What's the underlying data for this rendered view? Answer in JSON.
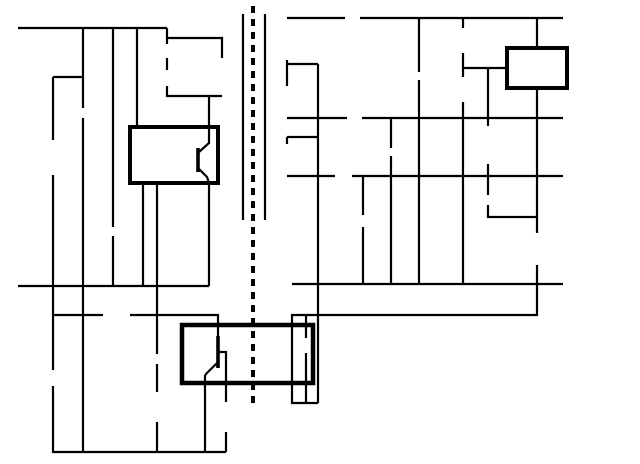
{
  "title": "LM2577 isolated flyback power supply schematic with red annotation",
  "colors": {
    "ink": "#000000",
    "annotation": "#dd1515",
    "bg": "#ffffff"
  },
  "annotations": {
    "circle": {
      "cx": 357,
      "cy": 119,
      "r": 26,
      "stroke_w": 5.5
    },
    "block_arrow": {
      "points": "358,40 378,40 378,61 389,61 368,88 347,61 358,61",
      "stroke_w": 5
    }
  },
  "texts": [
    {
      "t": "V",
      "x": 8,
      "y": 45,
      "s": 16
    },
    {
      "t": "IN",
      "x": 20,
      "y": 50,
      "s": 10
    },
    {
      "t": "16 - 36V",
      "x": 5,
      "y": 63,
      "s": 13
    },
    {
      "t": "+",
      "x": 66,
      "y": 104,
      "s": 15
    },
    {
      "t": "680",
      "x": 86,
      "y": 131,
      "s": 13
    },
    {
      "t": "µF",
      "x": 86,
      "y": 145,
      "s": 13
    },
    {
      "t": "10K",
      "x": 18,
      "y": 163,
      "s": 13
    },
    {
      "t": "0.1",
      "x": 87,
      "y": 200,
      "s": 13
    },
    {
      "t": "µF",
      "x": 87,
      "y": 214,
      "s": 13
    },
    {
      "t": "V",
      "x": 133,
      "y": 117,
      "s": 13
    },
    {
      "t": "IN",
      "x": 142,
      "y": 121,
      "s": 9
    },
    {
      "t": "SW",
      "x": 190,
      "y": 117,
      "s": 13
    },
    {
      "t": "LM2577",
      "x": 162,
      "y": 154,
      "s": 14,
      "a": "middle"
    },
    {
      "t": "ADJ",
      "x": 162,
      "y": 172,
      "s": 14,
      "a": "middle"
    },
    {
      "t": "FB",
      "x": 120,
      "y": 201,
      "s": 13
    },
    {
      "t": "COMP",
      "x": 164,
      "y": 201,
      "s": 13
    },
    {
      "t": "GND",
      "x": 216,
      "y": 201,
      "s": 13
    },
    {
      "t": "18T",
      "x": 186,
      "y": 69,
      "s": 13
    },
    {
      "t": "51V",
      "x": 175,
      "y": 83,
      "s": 13
    },
    {
      "t": "INPUT",
      "x": 3,
      "y": 263,
      "s": 13
    },
    {
      "t": "GND",
      "x": 3,
      "y": 279,
      "s": 13
    },
    {
      "t": "100k",
      "x": 97,
      "y": 335,
      "s": 13
    },
    {
      "t": "0.47µF",
      "x": 95,
      "y": 380,
      "s": 13
    },
    {
      "t": "2K",
      "x": 168,
      "y": 413,
      "s": 13
    },
    {
      "t": "4.7V",
      "x": 13,
      "y": 392,
      "s": 13
    },
    {
      "t": "4N27",
      "x": 201,
      "y": 315,
      "s": 14
    },
    {
      "t": "47K",
      "x": 232,
      "y": 418,
      "s": 13
    },
    {
      "t": "ISOLATION",
      "x": 264,
      "y": 234,
      "s": 12.5,
      "a": "middle",
      "r": -90
    },
    {
      "t": "16T",
      "x": 293,
      "y": 45,
      "s": 13
    },
    {
      "t": "24T",
      "x": 294,
      "y": 98,
      "s": 13
    },
    {
      "t": "24T",
      "x": 293,
      "y": 157,
      "s": 13
    },
    {
      "t": "470µF",
      "x": 401,
      "y": 78,
      "s": 13,
      "a": "end"
    },
    {
      "t": "+",
      "x": 404,
      "y": 67,
      "s": 14
    },
    {
      "t": "220µF",
      "x": 371,
      "y": 154,
      "s": 13,
      "a": "end"
    },
    {
      "t": "+",
      "x": 376,
      "y": 145,
      "s": 14
    },
    {
      "t": "100µF",
      "x": 318,
      "y": 212,
      "s": 13
    },
    {
      "t": "+",
      "x": 348,
      "y": 243,
      "s": 14
    },
    {
      "t": "R1",
      "x": 452,
      "y": 38,
      "s": 13,
      "a": "end"
    },
    {
      "t": "15K",
      "x": 452,
      "y": 52,
      "s": 13,
      "a": "end"
    },
    {
      "t": "R2",
      "x": 452,
      "y": 92,
      "s": 13,
      "a": "end"
    },
    {
      "t": "45.3K",
      "x": 456,
      "y": 106,
      "s": 13,
      "a": "end"
    },
    {
      "t": "FB",
      "x": 485,
      "y": 63,
      "s": 13,
      "a": "end"
    },
    {
      "t": "LM385",
      "x": 537,
      "y": 74,
      "s": 14,
      "a": "middle"
    },
    {
      "t": "+",
      "x": 521,
      "y": 44,
      "s": 15
    },
    {
      "t": "-",
      "x": 525,
      "y": 101,
      "s": 17
    },
    {
      "t": "220",
      "x": 496,
      "y": 149,
      "s": 13
    },
    {
      "t": "0.1",
      "x": 511,
      "y": 194,
      "s": 13
    },
    {
      "t": "µF",
      "x": 511,
      "y": 208,
      "s": 13
    },
    {
      "t": "470",
      "x": 529,
      "y": 256,
      "s": 13,
      "a": "end"
    },
    {
      "t": "5V@",
      "x": 582,
      "y": 19,
      "s": 14
    },
    {
      "t": "150mA",
      "x": 582,
      "y": 35,
      "s": 14
    },
    {
      "t": "7.5V@",
      "x": 582,
      "y": 118,
      "s": 14
    },
    {
      "t": "100mA",
      "x": 582,
      "y": 134,
      "s": 14
    },
    {
      "t": "-7.5V@",
      "x": 579,
      "y": 176,
      "s": 14
    },
    {
      "t": "70mA",
      "x": 582,
      "y": 192,
      "s": 14
    },
    {
      "t": "OUTPUT",
      "x": 575,
      "y": 284,
      "s": 14
    },
    {
      "t": "GND",
      "x": 588,
      "y": 300,
      "s": 14
    }
  ],
  "geometry": {
    "wires": [
      [
        [
          18,
          28
        ],
        [
          167,
          28
        ]
      ],
      [
        [
          83,
          28
        ],
        [
          83,
          108
        ]
      ],
      [
        [
          83,
          118
        ],
        [
          83,
          452
        ]
      ],
      [
        [
          113,
          28
        ],
        [
          113,
          227
        ]
      ],
      [
        [
          113,
          236
        ],
        [
          113,
          286
        ]
      ],
      [
        [
          137,
          28
        ],
        [
          137,
          127
        ]
      ],
      [
        [
          167,
          28
        ],
        [
          167,
          44
        ]
      ],
      [
        [
          167,
          58
        ],
        [
          167,
          70
        ]
      ],
      [
        [
          167,
          86
        ],
        [
          167,
          96
        ],
        [
          222,
          96
        ]
      ],
      [
        [
          209,
          96
        ],
        [
          209,
          127
        ]
      ],
      [
        [
          167,
          38
        ],
        [
          222,
          38
        ],
        [
          222,
          58
        ]
      ],
      [
        [
          53,
          77
        ],
        [
          83,
          77
        ]
      ],
      [
        [
          53,
          77
        ],
        [
          53,
          140
        ]
      ],
      [
        [
          53,
          175
        ],
        [
          53,
          370
        ]
      ],
      [
        [
          53,
          386
        ],
        [
          53,
          452
        ],
        [
          226,
          452
        ]
      ],
      [
        [
          18,
          286
        ],
        [
          209,
          286
        ]
      ],
      [
        [
          209,
          183
        ],
        [
          209,
          286
        ]
      ],
      [
        [
          143,
          183
        ],
        [
          143,
          286
        ]
      ],
      [
        [
          157,
          183
        ],
        [
          157,
          315
        ]
      ],
      [
        [
          53,
          315
        ],
        [
          103,
          315
        ]
      ],
      [
        [
          130,
          315
        ],
        [
          157,
          315
        ]
      ],
      [
        [
          157,
          315
        ],
        [
          218,
          315
        ],
        [
          218,
          336
        ]
      ],
      [
        [
          218,
          352
        ],
        [
          226,
          352
        ],
        [
          226,
          402
        ]
      ],
      [
        [
          226,
          432
        ],
        [
          226,
          452
        ]
      ],
      [
        [
          157,
          315
        ],
        [
          157,
          354
        ]
      ],
      [
        [
          157,
          364
        ],
        [
          157,
          392
        ]
      ],
      [
        [
          157,
          422
        ],
        [
          157,
          452
        ]
      ],
      [
        [
          209,
          127
        ],
        [
          209,
          143
        ],
        [
          199,
          152
        ]
      ],
      [
        [
          198,
          168
        ],
        [
          207,
          177
        ],
        [
          209,
          183
        ]
      ],
      [
        [
          218,
          362
        ],
        [
          205,
          375
        ]
      ],
      [
        [
          205,
          375
        ],
        [
          205,
          452
        ]
      ],
      [
        [
          243,
          14
        ],
        [
          243,
          220
        ]
      ],
      [
        [
          265,
          14
        ],
        [
          265,
          220
        ]
      ],
      [
        [
          287,
          18
        ],
        [
          345,
          18
        ]
      ],
      [
        [
          360,
          18
        ],
        [
          563,
          18
        ]
      ],
      [
        [
          419,
          18
        ],
        [
          419,
          72
        ]
      ],
      [
        [
          419,
          80
        ],
        [
          419,
          284
        ]
      ],
      [
        [
          463,
          18
        ],
        [
          463,
          28
        ]
      ],
      [
        [
          463,
          53
        ],
        [
          463,
          77
        ]
      ],
      [
        [
          463,
          102
        ],
        [
          463,
          284
        ]
      ],
      [
        [
          463,
          68
        ],
        [
          507,
          68
        ]
      ],
      [
        [
          488,
          68
        ],
        [
          488,
          126
        ]
      ],
      [
        [
          488,
          164
        ],
        [
          488,
          195
        ]
      ],
      [
        [
          488,
          205
        ],
        [
          488,
          217
        ],
        [
          537,
          217
        ]
      ],
      [
        [
          537,
          18
        ],
        [
          537,
          48
        ]
      ],
      [
        [
          537,
          88
        ],
        [
          537,
          233
        ]
      ],
      [
        [
          537,
          265
        ],
        [
          537,
          315
        ],
        [
          292,
          315
        ],
        [
          292,
          403
        ],
        [
          318,
          403
        ]
      ],
      [
        [
          306,
          315
        ],
        [
          306,
          338
        ]
      ],
      [
        [
          306,
          353
        ],
        [
          306,
          403
        ]
      ],
      [
        [
          287,
          60
        ],
        [
          287,
          86
        ]
      ],
      [
        [
          287,
          118
        ],
        [
          347,
          118
        ]
      ],
      [
        [
          362,
          118
        ],
        [
          563,
          118
        ]
      ],
      [
        [
          287,
          64
        ],
        [
          318,
          64
        ]
      ],
      [
        [
          318,
          64
        ],
        [
          318,
          403
        ]
      ],
      [
        [
          287,
          137
        ],
        [
          318,
          137
        ]
      ],
      [
        [
          287,
          137
        ],
        [
          287,
          144
        ]
      ],
      [
        [
          287,
          176
        ],
        [
          335,
          176
        ]
      ],
      [
        [
          352,
          176
        ],
        [
          563,
          176
        ]
      ],
      [
        [
          391,
          118
        ],
        [
          391,
          148
        ]
      ],
      [
        [
          391,
          156
        ],
        [
          391,
          284
        ]
      ],
      [
        [
          363,
          176
        ],
        [
          363,
          215
        ]
      ],
      [
        [
          363,
          227
        ],
        [
          363,
          284
        ]
      ],
      [
        [
          292,
          284
        ],
        [
          563,
          284
        ]
      ]
    ],
    "thick_wires": [
      [
        [
          198,
          148
        ],
        [
          198,
          172
        ]
      ],
      [
        [
          218,
          336
        ],
        [
          218,
          368
        ]
      ]
    ],
    "dashed": {
      "x": 253,
      "y1": 6,
      "y2": 405,
      "w": 4,
      "dash": "7 6"
    },
    "boxes": [
      {
        "x": 130,
        "y": 127,
        "w": 88,
        "h": 56,
        "sw": 4,
        "name": "lm2577-box"
      },
      {
        "x": 507,
        "y": 48,
        "w": 60,
        "h": 40,
        "sw": 4,
        "name": "lm385-box"
      },
      {
        "x": 182,
        "y": 325,
        "w": 131,
        "h": 58,
        "sw": 4.5,
        "name": "4n27-box"
      }
    ],
    "resistors": [
      {
        "x": 53,
        "y": 140,
        "len": 35,
        "o": "v",
        "name": "resistor-10k"
      },
      {
        "x": 103,
        "y": 315,
        "len": 27,
        "o": "h",
        "name": "resistor-100k"
      },
      {
        "x": 157,
        "y": 392,
        "len": 30,
        "o": "v",
        "name": "resistor-2k"
      },
      {
        "x": 226,
        "y": 402,
        "len": 30,
        "o": "v",
        "name": "resistor-47k"
      },
      {
        "x": 463,
        "y": 28,
        "len": 25,
        "o": "v",
        "name": "resistor-r1-15k"
      },
      {
        "x": 463,
        "y": 77,
        "len": 25,
        "o": "v",
        "name": "resistor-r2-45k"
      },
      {
        "x": 488,
        "y": 126,
        "len": 38,
        "o": "v",
        "name": "resistor-220"
      },
      {
        "x": 537,
        "y": 233,
        "len": 32,
        "o": "v",
        "name": "resistor-470"
      }
    ],
    "capacitors": [
      {
        "cx": 83,
        "y1": 108,
        "y2": 118,
        "hw": 18,
        "name": "cap-680uF"
      },
      {
        "cx": 113,
        "y1": 227,
        "y2": 236,
        "hw": 18,
        "name": "cap-0.1uF-input"
      },
      {
        "cx": 157,
        "y1": 354,
        "y2": 364,
        "hw": 18,
        "name": "cap-0.47uF"
      },
      {
        "cx": 419,
        "y1": 72,
        "y2": 80,
        "hw": 16,
        "name": "cap-470uF"
      },
      {
        "cx": 391,
        "y1": 148,
        "y2": 156,
        "hw": 18,
        "name": "cap-220uF"
      },
      {
        "cx": 363,
        "y1": 215,
        "y2": 227,
        "hw": 18,
        "name": "cap-100uF"
      },
      {
        "cx": 488,
        "y1": 195,
        "y2": 205,
        "hw": 18,
        "name": "cap-0.1uF-output"
      }
    ],
    "diodes": [
      {
        "x": 167,
        "y": 51,
        "dir": "u",
        "z": false,
        "name": "diode-input-clamp"
      },
      {
        "x": 167,
        "y": 78,
        "dir": "d",
        "z": true,
        "name": "zener-51v"
      },
      {
        "x": 53,
        "y": 378,
        "dir": "d",
        "z": true,
        "name": "zener-4.7v"
      },
      {
        "x": 352,
        "y": 18,
        "dir": "r",
        "z": false,
        "name": "diode-5v-rectifier"
      },
      {
        "x": 354,
        "y": 118,
        "dir": "r",
        "z": false,
        "name": "diode-7.5v-rectifier"
      },
      {
        "x": 344,
        "y": 176,
        "dir": "l",
        "z": false,
        "name": "diode-neg7.5v-rectifier"
      },
      {
        "x": 306,
        "y": 345,
        "dir": "d",
        "z": false,
        "name": "optocoupler-led"
      }
    ],
    "squiggles": [
      {
        "x": 363,
        "y": 18
      },
      {
        "x": 366,
        "y": 118
      },
      {
        "x": 327,
        "y": 176
      }
    ],
    "windings": [
      {
        "x": 222,
        "y1": 58,
        "y2": 96,
        "side": "l",
        "n": 3,
        "name": "winding-18t-primary"
      },
      {
        "x": 287,
        "y1": 18,
        "y2": 60,
        "side": "r",
        "n": 3,
        "name": "winding-16t"
      },
      {
        "x": 287,
        "y1": 86,
        "y2": 118,
        "side": "r",
        "n": 3,
        "name": "winding-24t-upper"
      },
      {
        "x": 287,
        "y1": 144,
        "y2": 176,
        "side": "r",
        "n": 3,
        "name": "winding-24t-lower"
      }
    ],
    "junction_dots": [
      [
        83,
        28
      ],
      [
        113,
        28
      ],
      [
        137,
        28
      ],
      [
        167,
        28
      ],
      [
        83,
        77
      ],
      [
        209,
        96
      ],
      [
        83,
        286
      ],
      [
        113,
        286
      ],
      [
        143,
        286
      ],
      [
        53,
        315
      ],
      [
        157,
        315
      ],
      [
        83,
        452
      ],
      [
        157,
        452
      ],
      [
        205,
        452
      ],
      [
        419,
        18
      ],
      [
        463,
        18
      ],
      [
        537,
        18
      ],
      [
        463,
        68
      ],
      [
        488,
        68
      ],
      [
        391,
        118
      ],
      [
        363,
        176
      ],
      [
        537,
        217
      ],
      [
        318,
        137
      ],
      [
        318,
        284
      ],
      [
        363,
        284
      ],
      [
        391,
        284
      ],
      [
        419,
        284
      ],
      [
        463,
        284
      ],
      [
        306,
        315
      ],
      [
        306,
        403
      ]
    ],
    "phase_dots": [
      [
        229,
        54
      ],
      [
        281,
        63
      ],
      [
        281,
        71
      ],
      [
        281,
        181
      ]
    ],
    "arrows": [
      {
        "x": 17,
        "y": 28,
        "dir": "l",
        "name": "vin-arrow"
      },
      {
        "x": 17,
        "y": 286,
        "dir": "l",
        "name": "input-gnd-arrow"
      },
      {
        "x": 577,
        "y": 18,
        "dir": "r",
        "name": "out-5v-arrow"
      },
      {
        "x": 577,
        "y": 118,
        "dir": "r",
        "name": "out-7.5v-arrow"
      },
      {
        "x": 577,
        "y": 176,
        "dir": "r",
        "name": "out-neg7.5v-arrow"
      },
      {
        "x": 577,
        "y": 284,
        "dir": "r",
        "name": "output-gnd-arrow"
      }
    ],
    "wavy_arrows": [
      {
        "d": "M262,346 q-7,9 -14,4 q-7,-5 -14,2",
        "hx": 233,
        "hy": 353
      },
      {
        "d": "M262,358 q-7,9 -14,4 q-7,-5 -14,2",
        "hx": 233,
        "hy": 365
      }
    ]
  }
}
